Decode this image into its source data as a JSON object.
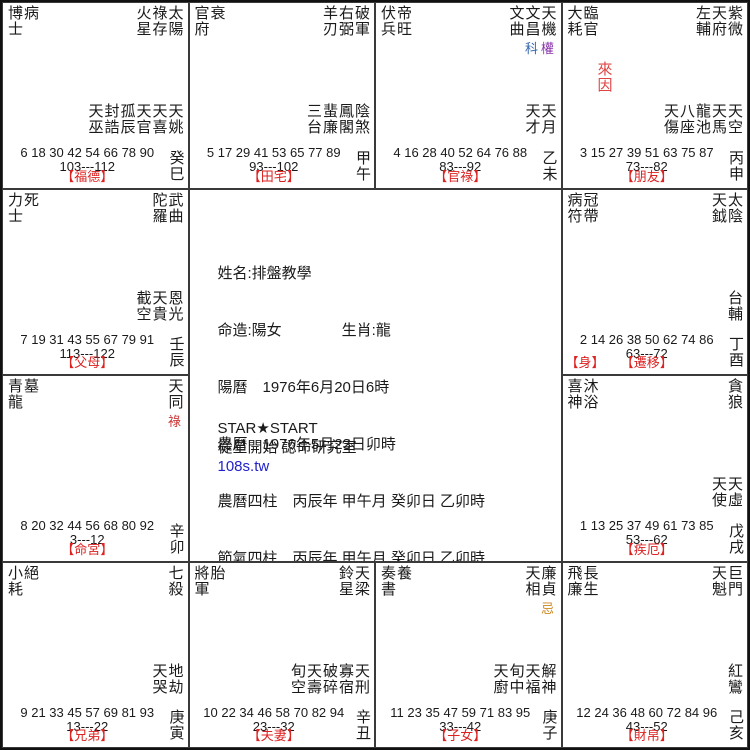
{
  "colors": {
    "palace_label_red": "#dd2222",
    "laiyin_red": "#dd4444",
    "hua_lu_red": "#cc3333",
    "hua_quan_purple": "#8833aa",
    "hua_ke_blue": "#3366aa",
    "hua_ji_orange": "#cc8822",
    "link_blue": "#2222cc",
    "grid_line": "#3a3a3a"
  },
  "center": {
    "info_lines": [
      "姓名:排盤教學",
      "命造:陽女　　　　生肖:龍",
      "陽曆　1976年6月20日6時",
      "農曆　1976年5月23日卯時",
      "農曆四柱　丙辰年 甲午月 癸卯日 乙卯時",
      "節氣四柱　丙辰年 甲午月 癸卯日 乙卯時",
      "命局:木三局",
      "命宮:卯"
    ],
    "studio_name_en": "STAR★START",
    "studio_name_zh": "從星開始 認命研究室",
    "website": "108s.tw"
  },
  "cells": [
    {
      "branch": "si",
      "gods": [
        "博士",
        "病"
      ],
      "stars": [
        {
          "name": "火星"
        },
        {
          "name": "祿存"
        },
        {
          "name": "太陽"
        }
      ],
      "minor_stars": [
        "天巫",
        "封誥",
        "孤辰",
        "天官",
        "天喜",
        "天姚"
      ],
      "ages": [
        6,
        18,
        30,
        42,
        54,
        66,
        78,
        90
      ],
      "range": "103---112",
      "palace": "【福德】",
      "ganzhi": "癸巳"
    },
    {
      "branch": "wu",
      "gods": [
        "官府",
        "衰"
      ],
      "stars": [
        {
          "name": "羊刃"
        },
        {
          "name": "右弼"
        },
        {
          "name": "破軍"
        }
      ],
      "minor_stars": [
        "三台",
        "蜚廉",
        "鳳閣",
        "陰煞"
      ],
      "ages": [
        5,
        17,
        29,
        41,
        53,
        65,
        77,
        89
      ],
      "range": "93---102",
      "palace": "【田宅】",
      "ganzhi": "甲午"
    },
    {
      "branch": "wei",
      "gods": [
        "伏兵",
        "帝旺"
      ],
      "stars": [
        {
          "name": "文曲"
        },
        {
          "name": "文昌",
          "hua": "科",
          "hua_color": "#3366aa"
        },
        {
          "name": "天機",
          "hua": "權",
          "hua_color": "#8833aa"
        }
      ],
      "minor_stars": [
        "天才",
        "天月"
      ],
      "ages": [
        4,
        16,
        28,
        40,
        52,
        64,
        76,
        88
      ],
      "range": "83---92",
      "palace": "【官祿】",
      "ganzhi": "乙未"
    },
    {
      "branch": "shen",
      "gods": [
        "大耗",
        "臨官"
      ],
      "stars": [
        {
          "name": "左輔"
        },
        {
          "name": "天府"
        },
        {
          "name": "紫微"
        }
      ],
      "minor_stars": [
        "天傷",
        "八座",
        "龍池",
        "天馬",
        "天空"
      ],
      "laiyin": "來因",
      "ages": [
        3,
        15,
        27,
        39,
        51,
        63,
        75,
        87
      ],
      "range": "73---82",
      "palace": "【朋友】",
      "ganzhi": "丙申"
    },
    {
      "branch": "chen",
      "gods": [
        "力士",
        "死"
      ],
      "stars": [
        {
          "name": "陀羅"
        },
        {
          "name": "武曲"
        }
      ],
      "minor_stars": [
        "截空",
        "天貴",
        "恩光"
      ],
      "ages": [
        7,
        19,
        31,
        43,
        55,
        67,
        79,
        91
      ],
      "range": "113---122",
      "palace": "【父母】",
      "ganzhi": "壬辰"
    },
    {
      "branch": "you",
      "gods": [
        "病符",
        "冠帶"
      ],
      "stars": [
        {
          "name": "天鉞"
        },
        {
          "name": "太陰"
        }
      ],
      "minor_stars": [
        "台輔"
      ],
      "body_tag": "【身】",
      "ages": [
        2,
        14,
        26,
        38,
        50,
        62,
        74,
        86
      ],
      "range": "63---72",
      "palace": "【遷移】",
      "ganzhi": "丁酉"
    },
    {
      "branch": "mao",
      "gods": [
        "青龍",
        "墓"
      ],
      "stars": [
        {
          "name": "天同",
          "hua": "祿",
          "hua_color": "#cc3333"
        }
      ],
      "minor_stars": [],
      "ages": [
        8,
        20,
        32,
        44,
        56,
        68,
        80,
        92
      ],
      "range": "3---12",
      "palace": "【命宮】",
      "ganzhi": "辛卯"
    },
    {
      "branch": "xu",
      "gods": [
        "喜神",
        "沐浴"
      ],
      "stars": [
        {
          "name": "貪狼"
        }
      ],
      "minor_stars": [
        "天使",
        "天虛"
      ],
      "ages": [
        1,
        13,
        25,
        37,
        49,
        61,
        73,
        85
      ],
      "range": "53---62",
      "palace": "【疾厄】",
      "ganzhi": "戊戌"
    },
    {
      "branch": "yin",
      "gods": [
        "小耗",
        "絕"
      ],
      "stars": [
        {
          "name": "七殺"
        }
      ],
      "minor_stars": [
        "天哭",
        "地劫"
      ],
      "ages": [
        9,
        21,
        33,
        45,
        57,
        69,
        81,
        93
      ],
      "range": "13---22",
      "palace": "【兄弟】",
      "ganzhi": "庚寅"
    },
    {
      "branch": "chou",
      "gods": [
        "將軍",
        "胎"
      ],
      "stars": [
        {
          "name": "鈴星"
        },
        {
          "name": "天梁"
        }
      ],
      "minor_stars": [
        "旬空",
        "天壽",
        "破碎",
        "寡宿",
        "天刑"
      ],
      "ages": [
        10,
        22,
        34,
        46,
        58,
        70,
        82,
        94
      ],
      "range": "23---32",
      "palace": "【夫妻】",
      "ganzhi": "辛丑"
    },
    {
      "branch": "zi",
      "gods": [
        "奏書",
        "養"
      ],
      "stars": [
        {
          "name": "天相"
        },
        {
          "name": "廉貞",
          "hua": "忌",
          "hua_color": "#cc8822"
        }
      ],
      "minor_stars": [
        "天廚",
        "旬中",
        "天福",
        "解神"
      ],
      "ages": [
        11,
        23,
        35,
        47,
        59,
        71,
        83,
        95
      ],
      "range": "33---42",
      "palace": "【子女】",
      "ganzhi": "庚子"
    },
    {
      "branch": "hai",
      "gods": [
        "飛廉",
        "長生"
      ],
      "stars": [
        {
          "name": "天魁"
        },
        {
          "name": "巨門"
        }
      ],
      "minor_stars": [
        "紅鸞"
      ],
      "ages": [
        12,
        24,
        36,
        48,
        60,
        72,
        84,
        96
      ],
      "range": "43---52",
      "palace": "【財帛】",
      "ganzhi": "己亥"
    }
  ]
}
